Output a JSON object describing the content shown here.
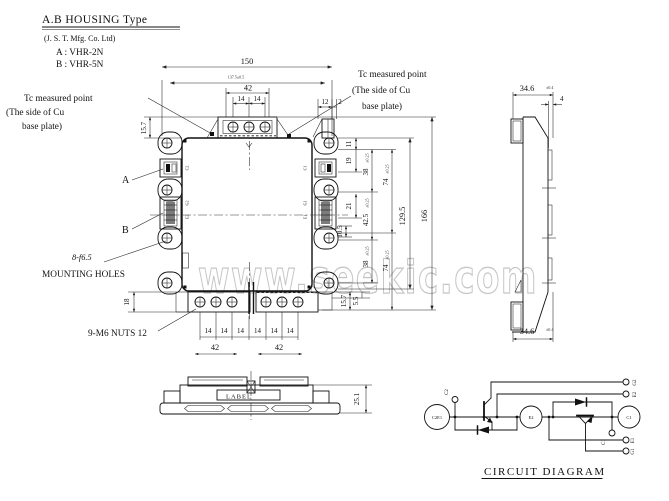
{
  "header": {
    "title": "A.B HOUSING Type",
    "manufacturer": "(J. S. T. Mfg. Co. Ltd)",
    "type_a": "A : VHR-2N",
    "type_b": "B : VHR-5N"
  },
  "notes": {
    "tc_left_1": "Tc measured point",
    "tc_left_2": "(The side of Cu",
    "tc_left_3": "base plate)",
    "tc_right_1": "Tc measured point",
    "tc_right_2": "(The side of Cu",
    "tc_right_3": "base plate)",
    "label_a": "A",
    "label_b": "B",
    "mounting_spec": "8-f6.5",
    "mounting_text": "MOUNTING HOLES",
    "nuts": "9-M6 NUTS 12",
    "label_plate": "LABEL"
  },
  "dims": {
    "d150": "150",
    "d_inner": "137.5±0.5",
    "d42": "42",
    "d14": "14",
    "d12": "12",
    "d2": "2",
    "d157": "15.7",
    "d18": "18",
    "d55": "5.5",
    "d11": "11",
    "d19": "19",
    "d21": "21",
    "d105": "10.5",
    "d38": "38",
    "d425": "42.5",
    "d74": "74",
    "d1295": "129.5",
    "d166": "166",
    "tol025": "±0.25",
    "d251": "25.1",
    "d346": "34.6",
    "tol346": "±0.4",
    "d4": "4"
  },
  "case_labels": {
    "left": [
      "C2",
      "G2",
      "E2"
    ],
    "right": [
      "C1",
      "G1",
      "E1"
    ]
  },
  "watermark": "www.seekic.com",
  "circuit": {
    "caption": "CIRCUIT DIAGRAM",
    "c2e1": "C2E1",
    "e2": "E2",
    "c1": "C1",
    "aux_c2": "C2",
    "aux_c1": "C1",
    "g2": "G2",
    "e2_aux": "E2",
    "e1": "E1",
    "g1": "G1"
  }
}
